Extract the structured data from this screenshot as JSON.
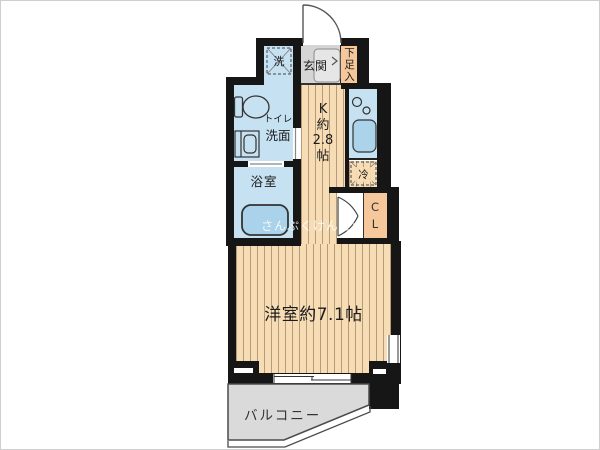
{
  "plan": {
    "type": "apartment-floor-plan",
    "colors": {
      "wall": "#161616",
      "wet_area_blue": "#c6e2f2",
      "fixture_blue": "#aad2ea",
      "flooring": "#f7ddb5",
      "flooring_stripe": "#b89a74",
      "entrance_gray": "#d5d5d5",
      "storage_orange": "#f5c79a",
      "balcony_gray": "#dadada"
    },
    "labels": {
      "washer": "洗",
      "entrance": "玄関",
      "shoe_storage": [
        "下",
        "足",
        "入"
      ],
      "washroom_line1": "トイレ",
      "washroom_line2": "洗面",
      "bathroom": "浴室",
      "kitchen": [
        "K",
        "約",
        "2.8",
        "帖"
      ],
      "fridge": "冷",
      "closet": [
        "C",
        "L"
      ],
      "main_room": "洋室約7.1帖",
      "balcony": "バルコニー",
      "watermark": "さんぷくけんせつ"
    }
  }
}
